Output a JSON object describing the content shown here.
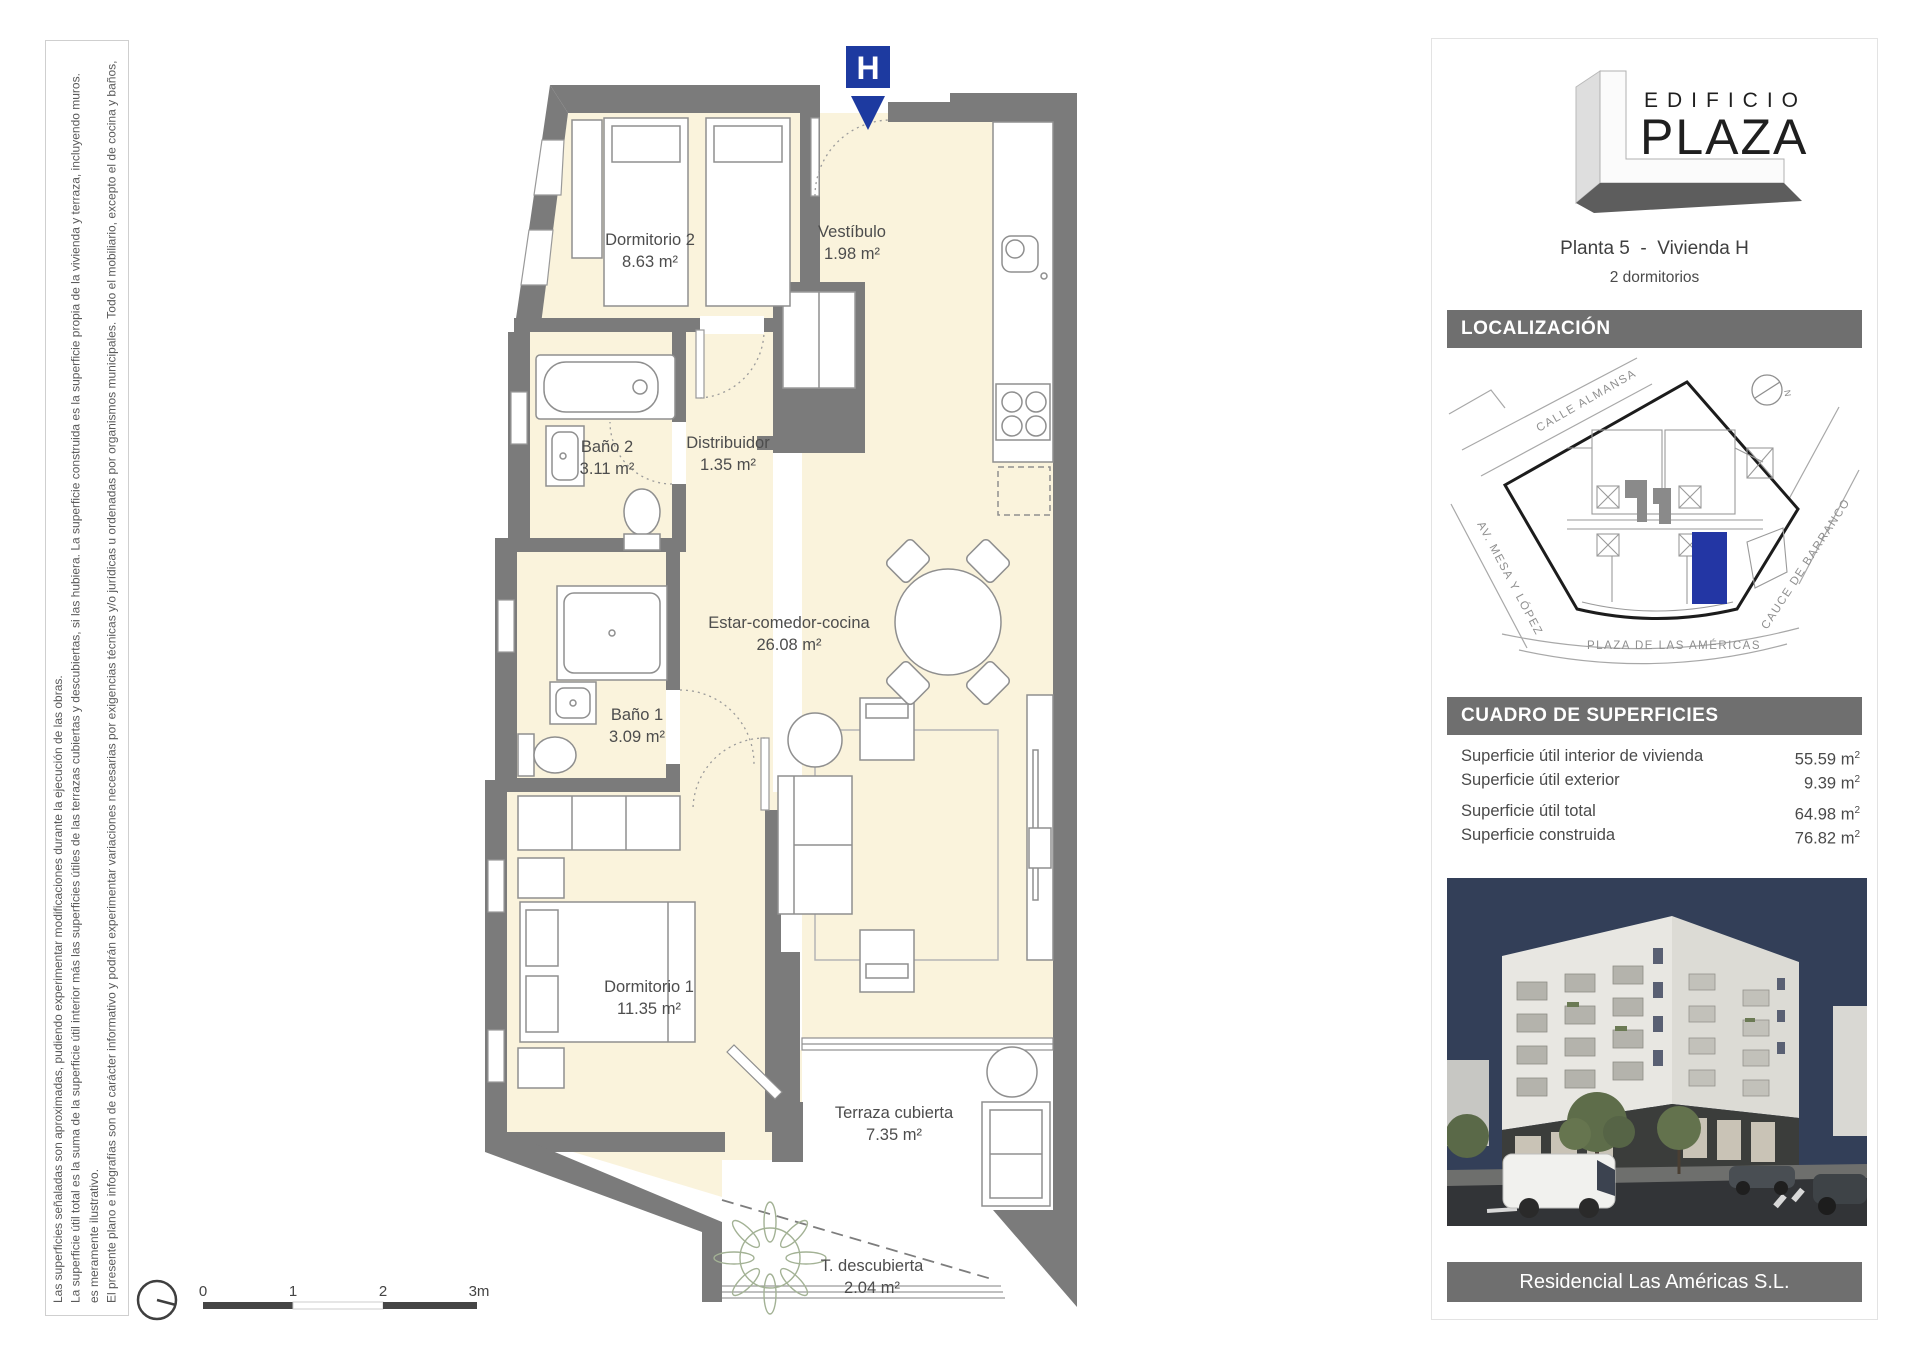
{
  "disclaimer": {
    "p1": "El presente plano e infografías son de carácter informativo y podrán experimentar variaciones necesarias por exigencias técnicas y/o jurídicas u ordenadas por organismos municipales. Todo el mobiliario, excepto el de cocina y baños, es meramente ilustrativo.",
    "p2": "La superficie útil total es la suma de la superficie útil interior más las superficies útiles de las terrazas cubiertas y descubiertas, si las hubiera. La superficie construida es la superficie propia de la vivienda y terraza, incluyendo muros. Las superficies señaladas son aproximadas, pudiendo experimentar modificaciones durante la ejecución de las obras."
  },
  "plan": {
    "unit_marker": "H",
    "rooms": [
      {
        "name": "Dormitorio 2",
        "area": "8.63 m²"
      },
      {
        "name": "Vestíbulo",
        "area": "1.98 m²"
      },
      {
        "name": "Baño 2",
        "area": "3.11 m²"
      },
      {
        "name": "Distribuidor",
        "area": "1.35 m²"
      },
      {
        "name": "Estar-comedor-cocina",
        "area": "26.08 m²"
      },
      {
        "name": "Baño 1",
        "area": "3.09 m²"
      },
      {
        "name": "Dormitorio 1",
        "area": "11.35 m²"
      },
      {
        "name": "Terraza cubierta",
        "area": "7.35 m²"
      },
      {
        "name": "T. descubierta",
        "area": "2.04 m²"
      }
    ],
    "scale_labels": [
      "0",
      "1",
      "2",
      "3m"
    ]
  },
  "panel": {
    "logo": {
      "line1": "EDIFICIO",
      "line2": "PLAZA"
    },
    "title": "Planta 5  -  Vivienda H",
    "subtitle": "2 dormitorios",
    "localizacion": {
      "header": "LOCALIZACIÓN",
      "streets": [
        "CALLE ALMANSA",
        "AV. MESA Y LÓPEZ",
        "CAUCE DE BARRANCO",
        "PLAZA DE LAS AMÉRICAS"
      ],
      "north_label": "N"
    },
    "superficies": {
      "header": "CUADRO DE SUPERFICIES",
      "rows": [
        {
          "label": "Superficie útil interior de vivienda",
          "value": "55.59",
          "unit": "m",
          "unit_sup": "2"
        },
        {
          "label": "Superficie útil exterior",
          "value": "9.39",
          "unit": "m",
          "unit_sup": "2"
        },
        {
          "label": "Superficie útil total",
          "value": "64.98",
          "unit": "m",
          "unit_sup": "2"
        },
        {
          "label": "Superficie construida",
          "value": "76.82",
          "unit": "m",
          "unit_sup": "2"
        }
      ]
    },
    "footer": "Residencial Las Américas S.L."
  },
  "colors": {
    "wall_gray": "#7b7b7b",
    "floor_cream": "#FAF3DC",
    "header_gray": "#6f6f6f",
    "accent_blue": "#1d3aa0"
  }
}
